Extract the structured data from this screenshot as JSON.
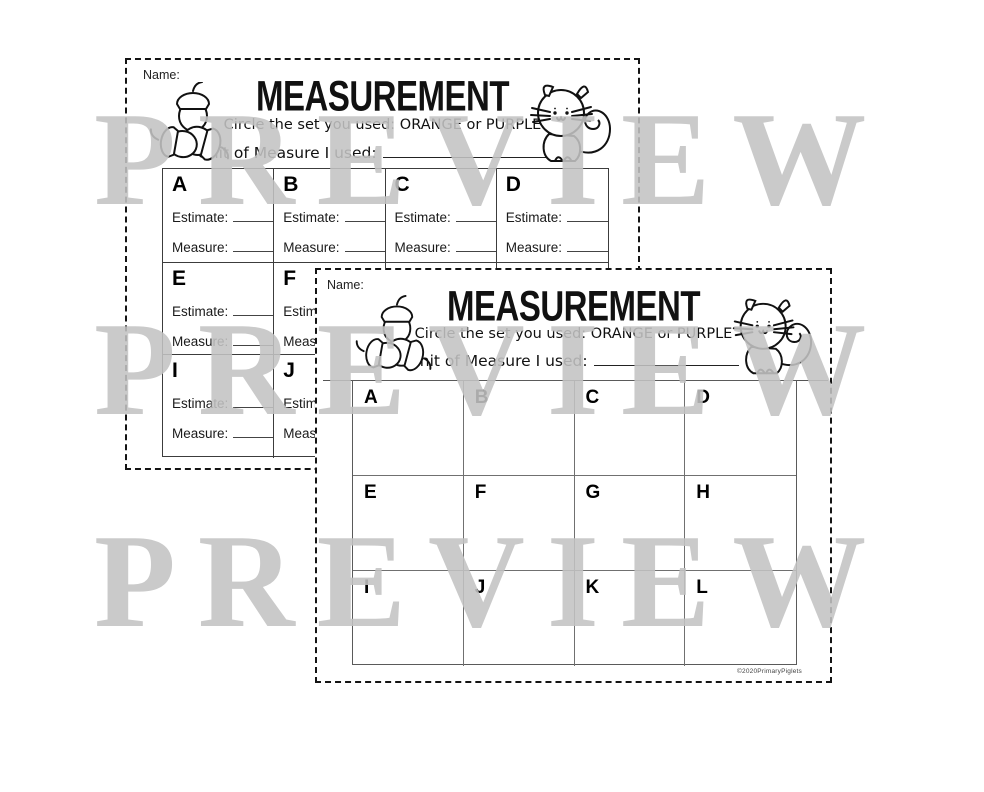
{
  "watermark": {
    "text": "PREVIEW",
    "color": "#c3c3c3"
  },
  "labels": {
    "name": "Name:",
    "estimate": "Estimate:",
    "measure": "Measure:"
  },
  "header": {
    "title": "MEASUREMENT",
    "subtitle": "Circle the set you used: ORANGE or PURPLE",
    "unit_label": "Unit of Measure I used:"
  },
  "back": {
    "letters": [
      "A",
      "B",
      "C",
      "D",
      "E",
      "F",
      "G",
      "H",
      "I",
      "J",
      "K",
      "L"
    ]
  },
  "front": {
    "letters": [
      "A",
      "B",
      "C",
      "D",
      "E",
      "F",
      "G",
      "H",
      "I",
      "J",
      "K",
      "L"
    ],
    "copyright": "©2020PrimaryPiglets"
  },
  "icons": {
    "left": "acorn-cluster-icon",
    "right": "squirrel-icon"
  }
}
